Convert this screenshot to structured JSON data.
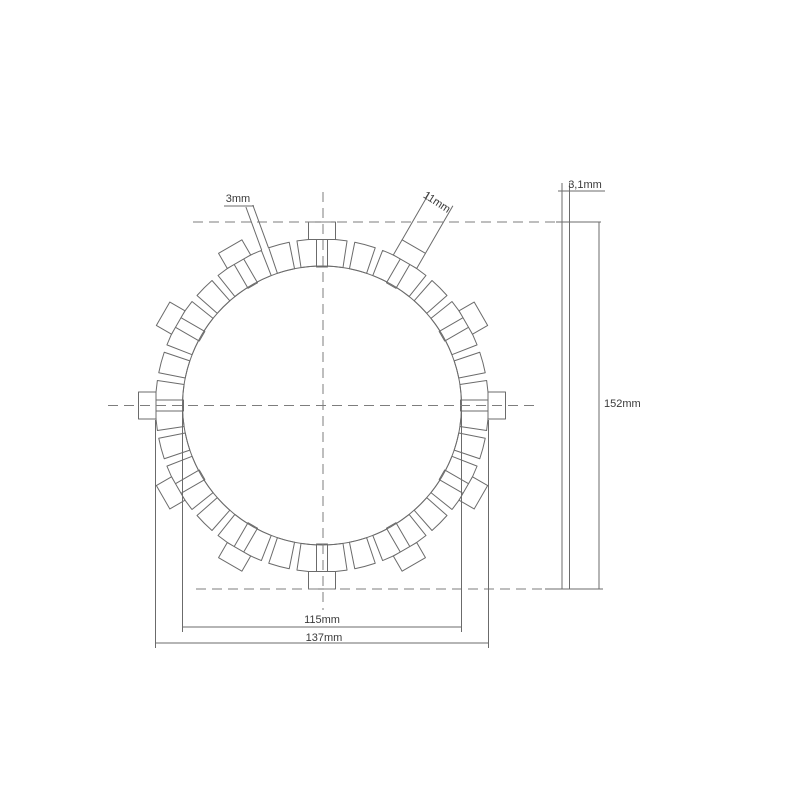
{
  "background": "#ffffff",
  "line_color": "#6b6b6b",
  "dash_color": "#7d7d7d",
  "text_color": "#3a3a3a",
  "labels": {
    "pad_gap": "3mm",
    "tab_width": "11mm",
    "plate_thickness": "3,1mm",
    "overall_diameter": "152mm",
    "inner_diameter": "115mm",
    "friction_outer_diameter": "137mm"
  },
  "front_view": {
    "cx": 322,
    "cy": 405.5,
    "inner_radius": 139.5,
    "pad_outer_radius": 166.5,
    "tab_outer_radius": 183.5,
    "pad_count": 36,
    "tab_count": 12,
    "gap_degrees": 2.7,
    "tab_width_px": 27,
    "stem_width_px": 11
  },
  "side_view": {
    "x": 562,
    "width": 7.5,
    "top": 222,
    "bottom": 589
  }
}
